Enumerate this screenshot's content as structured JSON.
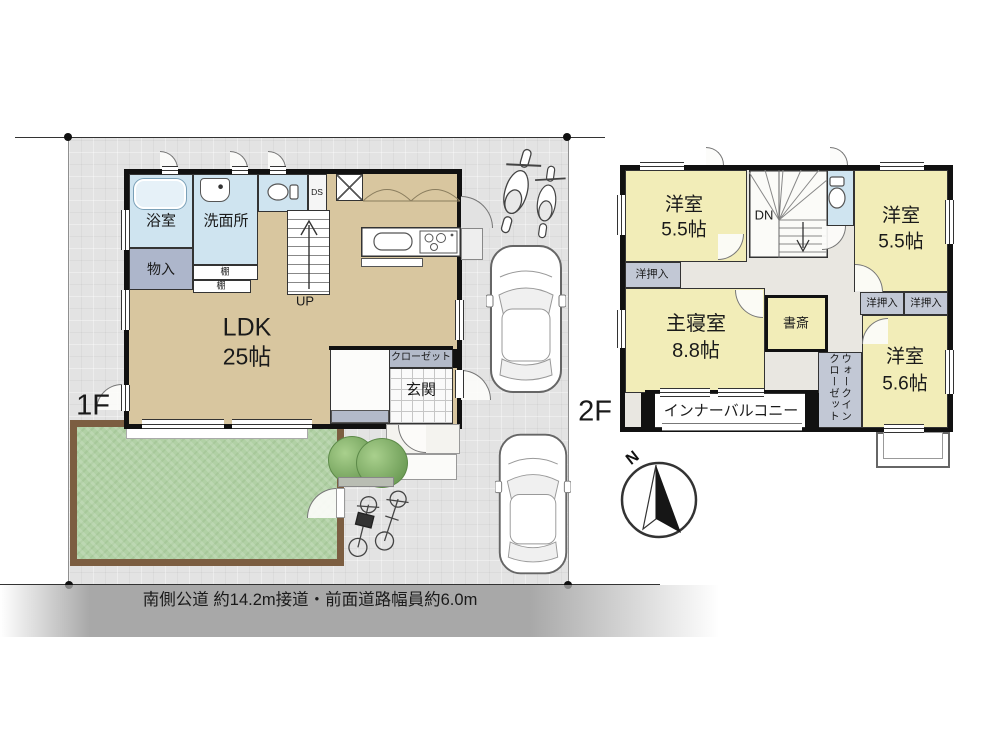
{
  "floor1": {
    "floor_label": "1F",
    "ldk_name": "LDK",
    "ldk_size": "25帖",
    "bath": "浴室",
    "washroom": "洗面所",
    "storage": "物入",
    "shelf_top": "棚",
    "shelf_bottom": "棚",
    "duct": "DS",
    "stairs_up": "UP",
    "closet": "クローゼット",
    "entrance": "玄関"
  },
  "floor2": {
    "floor_label": "2F",
    "stairs_down": "DN",
    "room_nw": {
      "name": "洋室",
      "size": "5.5帖"
    },
    "room_ne": {
      "name": "洋室",
      "size": "5.5帖"
    },
    "room_se": {
      "name": "洋室",
      "size": "5.6帖"
    },
    "master": {
      "name": "主寝室",
      "size": "8.8帖"
    },
    "study": "書斎",
    "closet_w": "洋押入",
    "closet_e1": "洋押入",
    "closet_e2": "洋押入",
    "walk_in_closet": "ウォークインクローゼット",
    "inner_balcony": "インナーバルコニー"
  },
  "site": {
    "road_note": "南側公道 約14.2m接道・前面道路幅員約6.0m",
    "compass_north": "N"
  },
  "colors": {
    "room_tan": "#d8c69f",
    "room_yellow": "#f2edb8",
    "wet_blue": "#cfe4f0",
    "closet_gray": "#b3bac9",
    "lawn_green": "#b1d1a5",
    "lawn_border": "#7c5e41",
    "road_gray": "#a8a8a8",
    "wall_black": "#111111"
  }
}
